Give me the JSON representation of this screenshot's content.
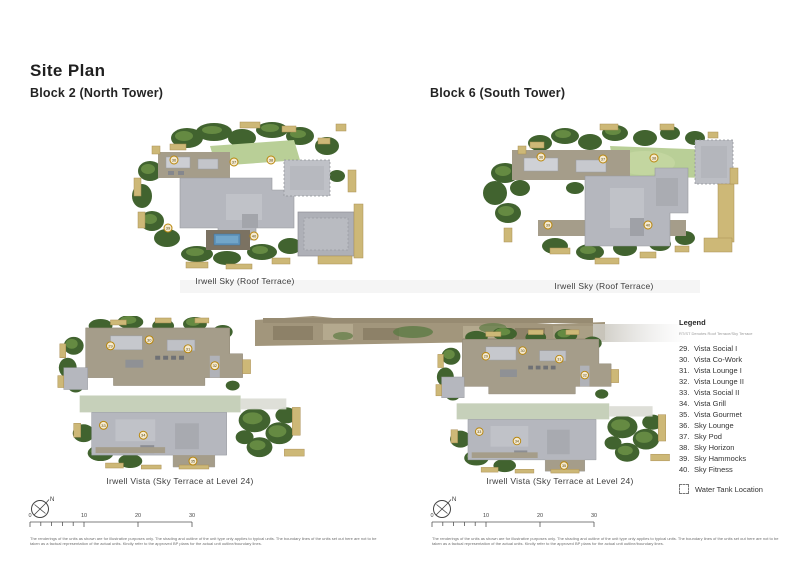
{
  "page": {
    "title": "Site Plan"
  },
  "palette": {
    "marker_gold": "#b8860b",
    "marker_fill": "#f5ead1",
    "parapet_tan": "#cdb877",
    "tree_green_dark": "#41632f",
    "tree_green_light": "#6c9146",
    "lawn_green": "#b9cf97",
    "roof_gray": "#b5b7be",
    "deck_walkway": "#a59d8a",
    "pool_blue": "#6094ba"
  },
  "plans": {
    "block2": {
      "heading": "Block 2 (North Tower)",
      "caption": "Irwell Sky (Roof Terrace)",
      "markers": [
        "36",
        "37",
        "38",
        "39",
        "40"
      ]
    },
    "block6": {
      "heading": "Block 6 (South Tower)",
      "caption": "Irwell Sky (Roof Terrace)",
      "markers": [
        "36",
        "37",
        "38",
        "39",
        "40"
      ]
    },
    "vista_left": {
      "caption": "Irwell Vista (Sky Terrace at Level 24)",
      "markers": [
        "29",
        "30",
        "31",
        "32",
        "33",
        "34",
        "35"
      ]
    },
    "vista_right": {
      "caption": "Irwell Vista (Sky Terrace at Level 24)",
      "markers": [
        "29",
        "30",
        "31",
        "32",
        "33",
        "34",
        "35"
      ]
    }
  },
  "legend": {
    "title": "Legend",
    "note": "RT/ST Denotes Roof Terrace/Sky Terrace",
    "items": [
      {
        "num": "29.",
        "label": "Vista Social I"
      },
      {
        "num": "30.",
        "label": "Vista Co-Work"
      },
      {
        "num": "31.",
        "label": "Vista Lounge I"
      },
      {
        "num": "32.",
        "label": "Vista Lounge II"
      },
      {
        "num": "33.",
        "label": "Vista Social II"
      },
      {
        "num": "34.",
        "label": "Vista Grill"
      },
      {
        "num": "35.",
        "label": "Vista Gourmet"
      },
      {
        "num": "36.",
        "label": "Sky Lounge"
      },
      {
        "num": "37.",
        "label": "Sky Pod"
      },
      {
        "num": "38.",
        "label": "Sky Horizon"
      },
      {
        "num": "39.",
        "label": "Sky Hammocks"
      },
      {
        "num": "40.",
        "label": "Sky Fitness"
      }
    ],
    "water_tank_label": "Water Tank Location"
  },
  "compass": {
    "north_label": "N"
  },
  "scalebar": {
    "labels": [
      "0",
      "10",
      "20",
      "30"
    ]
  },
  "disclaimer": {
    "text": "The renderings of the units as shown are for illustrative purposes only. The shading and outline of the unit type only applies to typical units. The boundary lines of the units set out here are not to be taken as a factual representation of the actual units. Kindly refer to the approved BP plans for the actual unit outline/boundary lines."
  }
}
